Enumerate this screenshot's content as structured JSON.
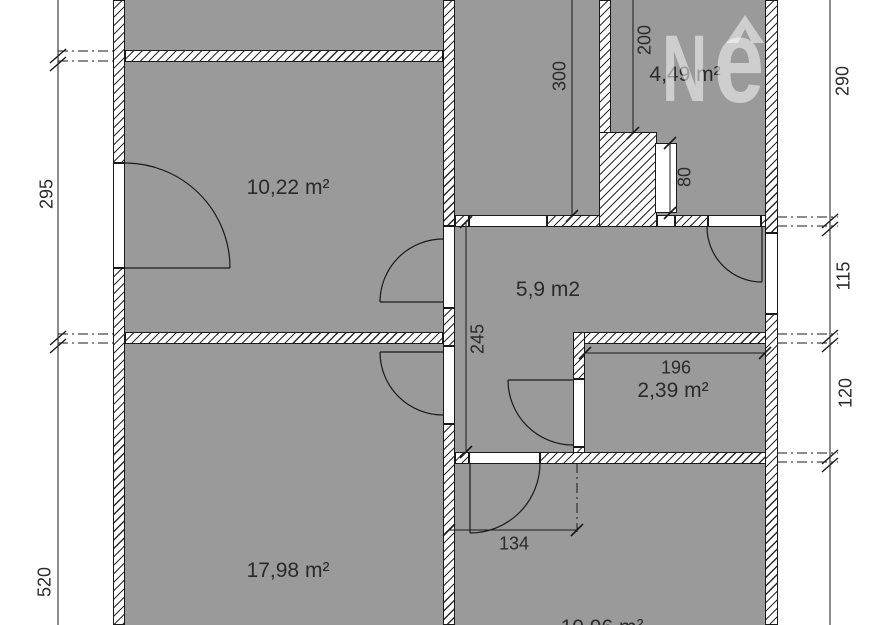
{
  "plan_type": "floor-plan",
  "rooms": [
    {
      "id": "room-top-left",
      "label": "10,22 m²",
      "area_m2": 10.22
    },
    {
      "id": "room-top-right",
      "label": "4,49 m²",
      "area_m2": 4.49
    },
    {
      "id": "hallway",
      "label": "5,9 m2",
      "area_m2": 5.9
    },
    {
      "id": "room-small",
      "label": "2,39 m²",
      "area_m2": 2.39
    },
    {
      "id": "room-bottom-left",
      "label": "17,98 m²",
      "area_m2": 17.98
    },
    {
      "id": "room-bottom-partial",
      "label": "10,96 m²",
      "area_m2": null
    }
  ],
  "dims": {
    "v295": "295",
    "v520": "520",
    "v300": "300",
    "v200": "200",
    "v80": "80",
    "v290": "290",
    "v115": "115",
    "v120": "120",
    "v245": "245",
    "h196": "196",
    "h134": "134"
  },
  "watermark": {
    "letter_n": "N",
    "letter_e": "e"
  },
  "colors": {
    "room_fill": "#9a9a9a",
    "line": "#1a1a1a",
    "background": "#ffffff",
    "watermark": "rgba(255,255,255,0.52)"
  }
}
